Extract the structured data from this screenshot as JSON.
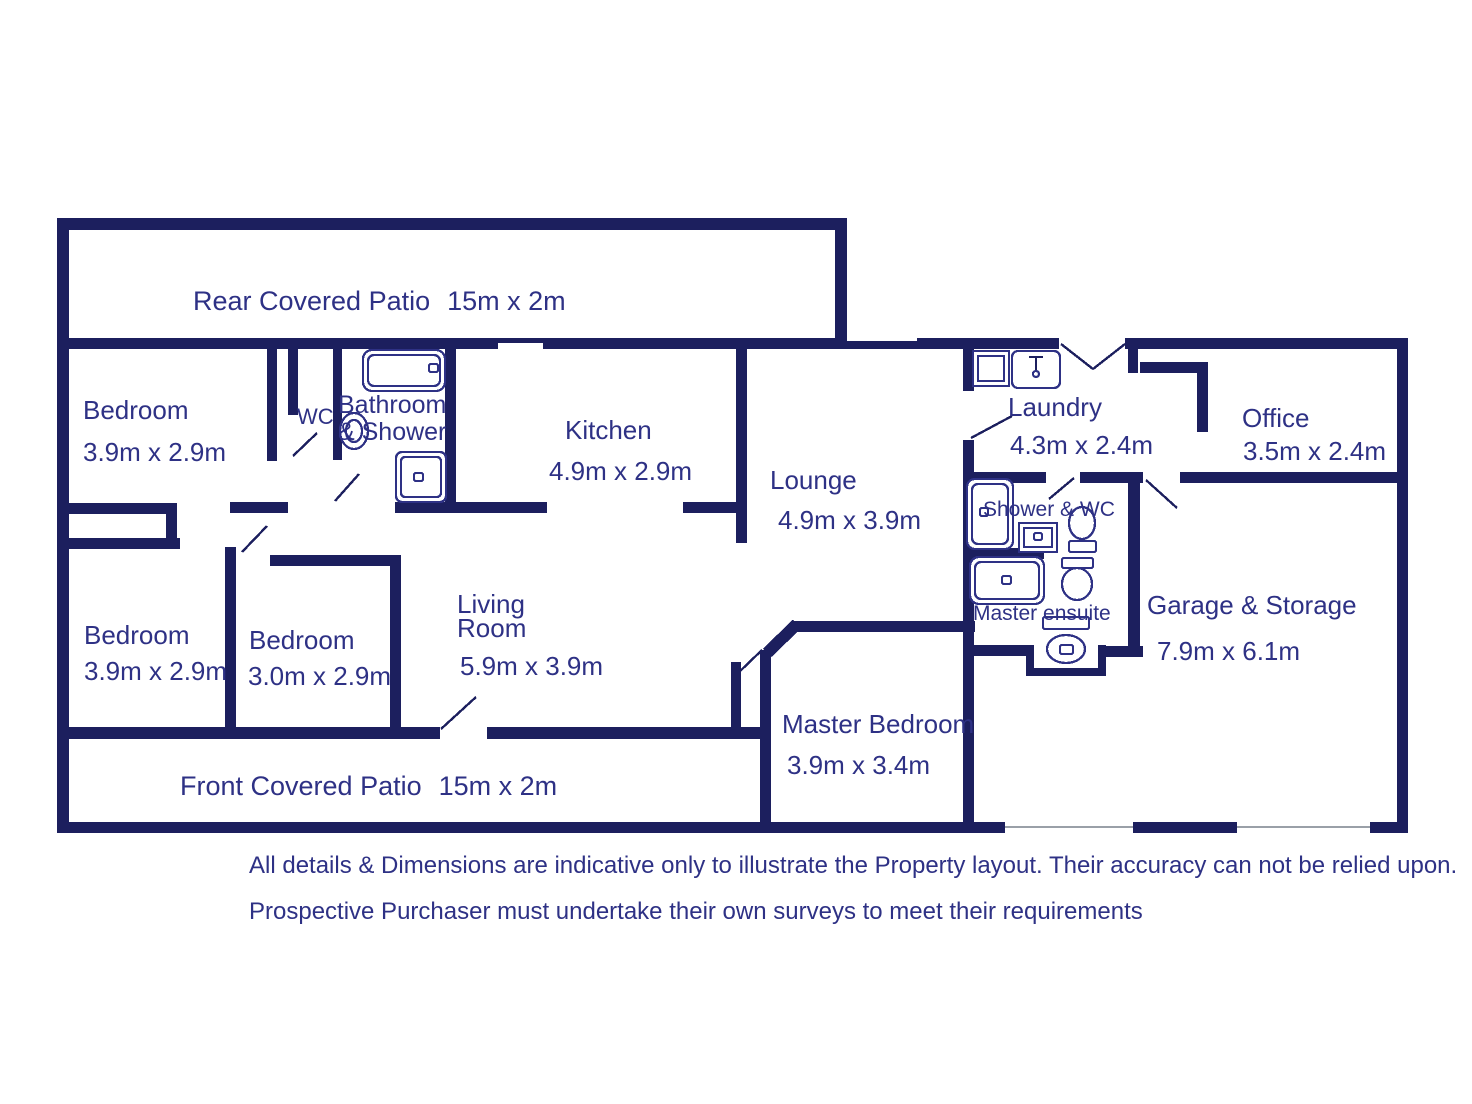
{
  "colors": {
    "wall": "#1c1f5e",
    "text": "#2e3185",
    "background": "#ffffff",
    "opening_line": "#9aa0a8"
  },
  "rooms": [
    {
      "id": "rear-patio",
      "lines": [
        "Rear Covered Patio",
        "15m x 2m"
      ]
    },
    {
      "id": "bedroom-top-left",
      "lines": [
        "Bedroom",
        "3.9m x 2.9m"
      ]
    },
    {
      "id": "wc",
      "lines": [
        "WC"
      ]
    },
    {
      "id": "bathroom",
      "lines": [
        "Bathroom",
        "& Shower"
      ]
    },
    {
      "id": "kitchen",
      "lines": [
        "Kitchen",
        "4.9m x 2.9m"
      ]
    },
    {
      "id": "lounge",
      "lines": [
        "Lounge",
        "4.9m x 3.9m"
      ]
    },
    {
      "id": "laundry",
      "lines": [
        "Laundry",
        "4.3m x 2.4m"
      ]
    },
    {
      "id": "office",
      "lines": [
        "Office",
        "3.5m x 2.4m"
      ]
    },
    {
      "id": "shower-wc",
      "lines": [
        "Shower & WC"
      ]
    },
    {
      "id": "master-ensuite",
      "lines": [
        "Master ensuite"
      ]
    },
    {
      "id": "garage",
      "lines": [
        "Garage & Storage",
        "7.9m x 6.1m"
      ]
    },
    {
      "id": "bedroom-bottom-left",
      "lines": [
        "Bedroom",
        "3.9m x 2.9m"
      ]
    },
    {
      "id": "bedroom-bottom-mid",
      "lines": [
        "Bedroom",
        "3.0m x 2.9m"
      ]
    },
    {
      "id": "living-room",
      "lines": [
        "Living",
        "Room",
        "5.9m x 3.9m"
      ]
    },
    {
      "id": "master-bedroom",
      "lines": [
        "Master Bedroom",
        "3.9m x 3.4m"
      ]
    },
    {
      "id": "front-patio",
      "lines": [
        "Front Covered Patio",
        "15m x 2m"
      ]
    }
  ],
  "fixtures": [
    {
      "name": "bathtub",
      "room": "bathroom"
    },
    {
      "name": "pedestal-basin",
      "room": "bathroom"
    },
    {
      "name": "shower-tray",
      "room": "bathroom"
    },
    {
      "name": "washing-machine",
      "room": "laundry"
    },
    {
      "name": "laundry-sink",
      "room": "laundry"
    },
    {
      "name": "shower-tray",
      "room": "shower-wc"
    },
    {
      "name": "wash-basin",
      "room": "shower-wc"
    },
    {
      "name": "toilet",
      "room": "shower-wc"
    },
    {
      "name": "bathtub",
      "room": "master-ensuite"
    },
    {
      "name": "toilet",
      "room": "master-ensuite"
    },
    {
      "name": "toilet-with-cistern",
      "room": "master-ensuite"
    }
  ],
  "disclaimer": {
    "line1": "All details & Dimensions are indicative only to illustrate the Property layout. Their accuracy can not be relied upon.",
    "line2": "Prospective Purchaser must undertake their own surveys to meet their requirements"
  }
}
